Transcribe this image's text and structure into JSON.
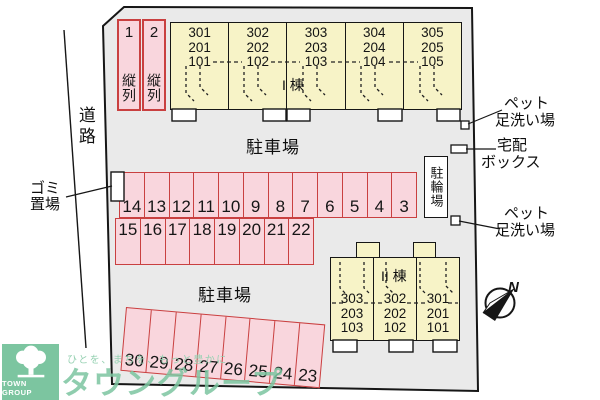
{
  "map": {
    "road_label": "道路",
    "parking_label_top": "駐車場",
    "parking_label_bottom": "駐車場",
    "bicycle_parking_label": "駐輪場",
    "trash_area": {
      "line1": "ゴミ",
      "line2": "置場"
    },
    "pet_wash_top": {
      "line1": "ペット",
      "line2": "足洗い場"
    },
    "delivery_box": {
      "line1": "宅配",
      "line2": "ボックス"
    },
    "pet_wash_bottom": {
      "line1": "ペット",
      "line2": "足洗い場"
    },
    "compass_north": "N"
  },
  "tandem_spaces": [
    {
      "number": "1",
      "label": "縦列"
    },
    {
      "number": "2",
      "label": "縦列"
    }
  ],
  "building_1": {
    "name": "I 棟",
    "stacks": [
      {
        "units": [
          "301",
          "201",
          "101"
        ]
      },
      {
        "units": [
          "302",
          "202",
          "102"
        ]
      },
      {
        "units": [
          "303",
          "203",
          "103"
        ]
      },
      {
        "units": [
          "304",
          "204",
          "104"
        ]
      },
      {
        "units": [
          "305",
          "205",
          "105"
        ]
      }
    ]
  },
  "building_2": {
    "name": "II 棟",
    "stacks": [
      {
        "units": [
          "303",
          "203",
          "103"
        ]
      },
      {
        "units": [
          "302",
          "202",
          "102"
        ]
      },
      {
        "units": [
          "301",
          "201",
          "101"
        ]
      }
    ]
  },
  "parking": {
    "row_top": [
      "14",
      "13",
      "12",
      "11",
      "10",
      "9",
      "8",
      "7",
      "6",
      "5",
      "4",
      "3"
    ],
    "row_middle": [
      "15",
      "16",
      "17",
      "18",
      "19",
      "20",
      "21",
      "22"
    ],
    "row_bottom": [
      "30",
      "29",
      "28",
      "27",
      "26",
      "25",
      "24",
      "23"
    ]
  },
  "branding": {
    "brand_name": "TOWN GROUP",
    "tagline": "ひとを、まちを、もっと豊かに",
    "watermark": "タウングループ"
  },
  "colors": {
    "site_fill": "#eaeaea",
    "building_fill": "#f7f3c7",
    "parking_fill": "#f9d6dd",
    "parking_border": "#c94040",
    "line_black": "#161616",
    "brand_green": "#7cc5a0"
  }
}
